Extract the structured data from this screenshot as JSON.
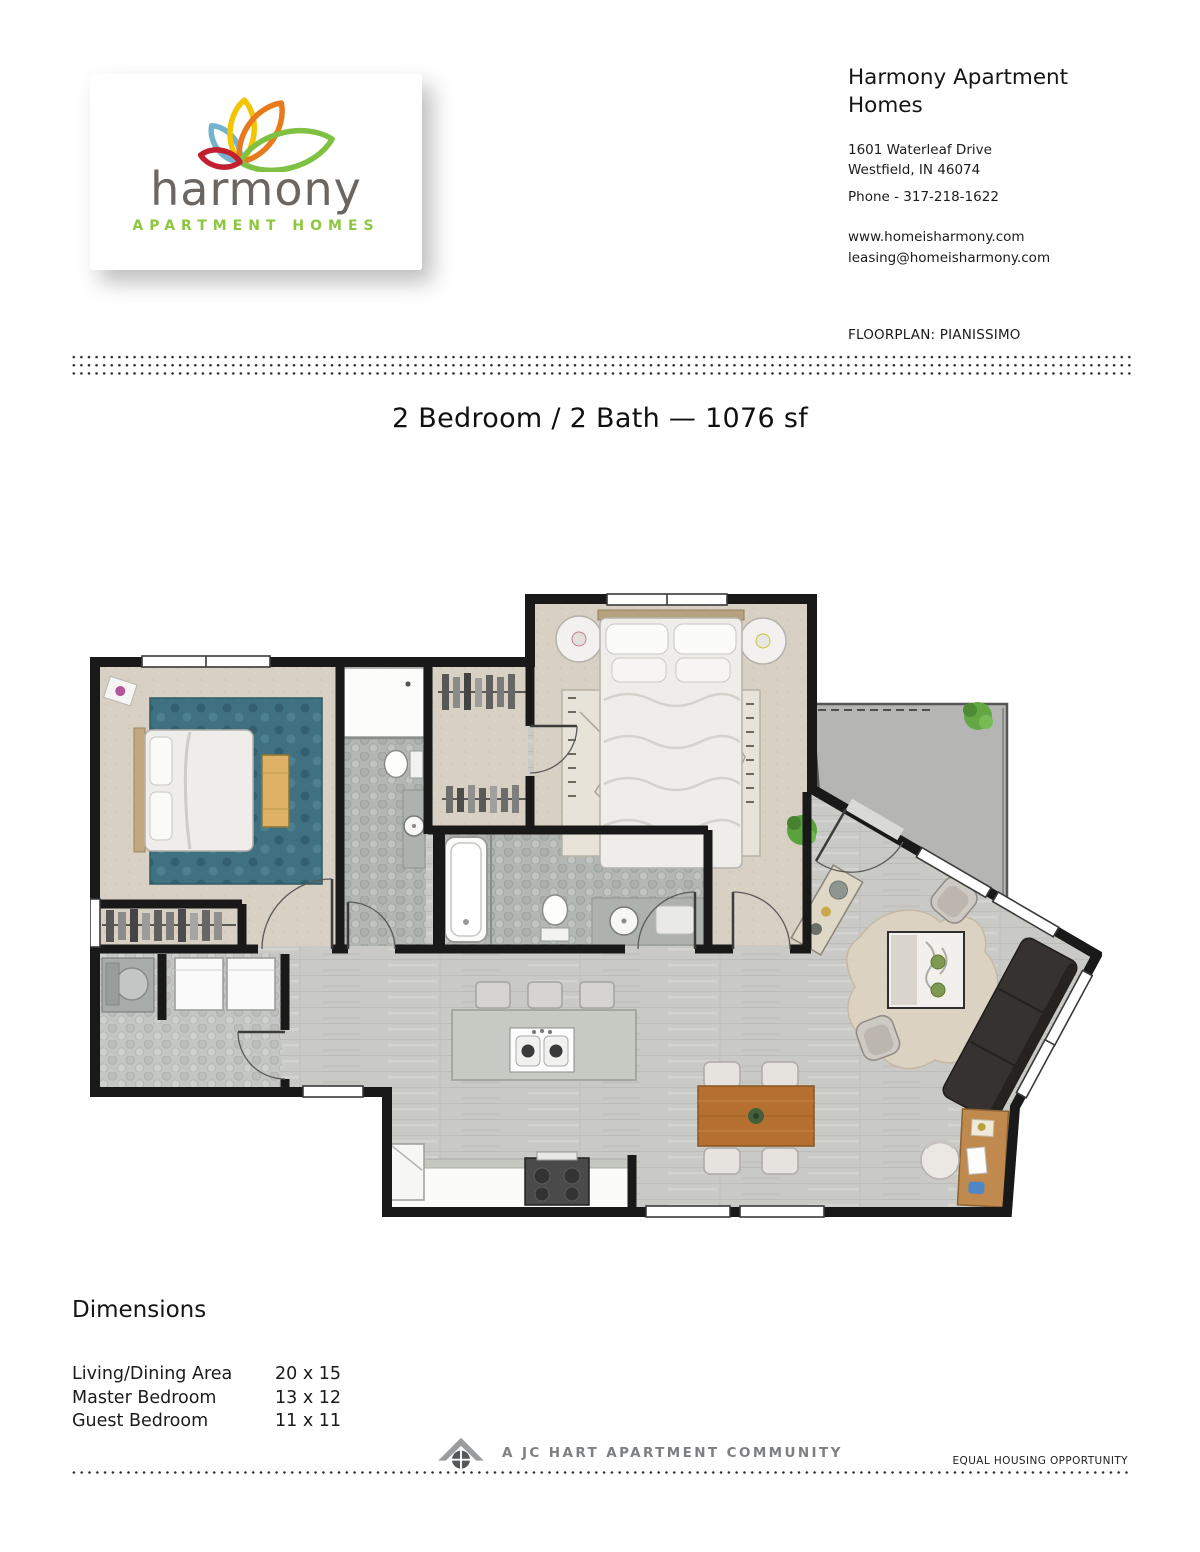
{
  "colors": {
    "brand-green": "#8dc63f",
    "brand-gray": "#6b6662",
    "petal-blue": "#74b3cd",
    "petal-yellow": "#f2c500",
    "petal-orange": "#e87a1e",
    "petal-green": "#7fc142",
    "petal-red": "#c21f2f",
    "ink": "#1b1b1b",
    "wall": "#191919",
    "carpet": "#d7d0c3",
    "tile": "#b3b7b4",
    "wood-floor": "#c9c9c6",
    "patio": "#b5b6b3",
    "rug-teal": "#3f7180",
    "sofa": "#35322f",
    "table-wood": "#b5702f",
    "desk-wood": "#c08a4e",
    "bench": "#ddb267",
    "footer-gray": "#7d7f82"
  },
  "logo": {
    "brand": "harmony",
    "tagline": "APARTMENT HOMES"
  },
  "contact": {
    "title": "Harmony Apartment Homes",
    "address_line1": "1601 Waterleaf Drive",
    "address_line2": "Westfield, IN 46074",
    "phone": "Phone - 317-218-1622",
    "website": "www.homeisharmony.com",
    "email": "leasing@homeisharmony.com"
  },
  "floorplan": {
    "label": "FLOORPLAN: PIANISSIMO",
    "title": "2 Bedroom / 2 Bath — 1076 sf"
  },
  "dimensions": {
    "heading": "Dimensions",
    "rows": [
      {
        "label": "Living/Dining Area",
        "value": "20 x 15"
      },
      {
        "label": "Master Bedroom",
        "value": "13 x 12"
      },
      {
        "label": "Guest Bedroom",
        "value": "11 x 11"
      }
    ]
  },
  "footer": {
    "community": "A JC HART APARTMENT COMMUNITY",
    "equal_housing": "EQUAL HOUSING OPPORTUNITY"
  }
}
